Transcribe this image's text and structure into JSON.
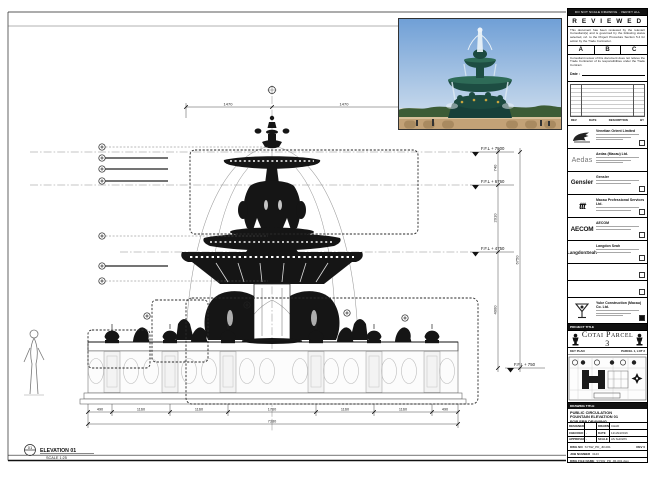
{
  "sheet": {
    "top_strip": "DO NOT SCALE DRAWING · VERIFY ALL DIMENSIONS ON SITE",
    "elevation_label": "ELEVATION 01",
    "elevation_scale": "SCALE 1:25",
    "detail_marker": "01"
  },
  "reviewed": {
    "title": "R E V I E W E D",
    "para1": "This document has been reviewed by the relevant Consultant(s) and is governed by the following status selected, ref. to the Project Procedure Section 5.4 for action by the Trade Contractor.",
    "option_a": "A",
    "option_b": "B",
    "option_c": "C",
    "para2": "Consultant review of this document does not relieve the Trade Contractor of its responsibilities under the Trade Contract.",
    "date_label": "Date :"
  },
  "revision_table": {
    "col_rev": "REV",
    "col_date": "DATE",
    "col_desc": "DESCRIPTION",
    "col_by": "BY"
  },
  "consultants": [
    {
      "name": "Venetian Orient Limited"
    },
    {
      "logo_text": "Aedas",
      "name": "Aedas (Macau) Ltd."
    },
    {
      "logo_text": "Gensler",
      "name": "Gensler"
    },
    {
      "logo_text": "ttt",
      "name": "Macau Professional Services Ltd."
    },
    {
      "logo_text": "AECOM",
      "name": "AECOM"
    },
    {
      "logo_text": "LangdonSeah",
      "name": "Langdon Seah"
    }
  ],
  "contractor": {
    "name": "Yuke Construction (Macau) Co. Ltd."
  },
  "project": {
    "label": "PROJECT TITLE",
    "title": "Cotai Parcel 3"
  },
  "key_plan": {
    "label": "KEY PLAN",
    "parcel": "PARCEL 1, LOT 2"
  },
  "title_block": {
    "drawing_title_label": "DRAWING TITLE",
    "title_line1": "PUBLIC CIRCULATION",
    "title_line2": "FOUNTAIN ELEVATION 01",
    "title_line3": "FOR FRP DRAWING",
    "designed_label": "DESIGNED",
    "designed": "",
    "drawn_label": "DRAWN",
    "drawn": "CHAD",
    "checked_label": "CHECKED",
    "checked": "-",
    "date_label": "DATE",
    "date": "12/JAN/2016",
    "approved_label": "APPROVED",
    "approved": "-",
    "scale_label": "SCALE",
    "scale": "AS SHOWN",
    "dwg_no_label": "DWG NO",
    "dwg_no": "SYSW_PD_JR-001",
    "rev": "REV 0",
    "job_label": "JOB NUMBER",
    "job": "3123",
    "file_label": "DWG FILE NAME",
    "file": "SYSW_PD_JR-001.dwg",
    "ref_label": "REFERENCE DWG FILE NAME"
  },
  "drawing": {
    "levels": [
      "F.F.L + 7500",
      "F.F.L + 6760",
      "F.F.L + 4750",
      "F.F.L + 750"
    ],
    "dims": {
      "top_left": "1470",
      "top_right": "1470",
      "right_1": "740",
      "right_2": "2010",
      "right_3": "4000",
      "right_total": "6750",
      "bottom_total": "7380",
      "bottom_segs": [
        "490",
        "1160",
        "1160",
        "1760",
        "1160",
        "1160",
        "490"
      ]
    }
  }
}
